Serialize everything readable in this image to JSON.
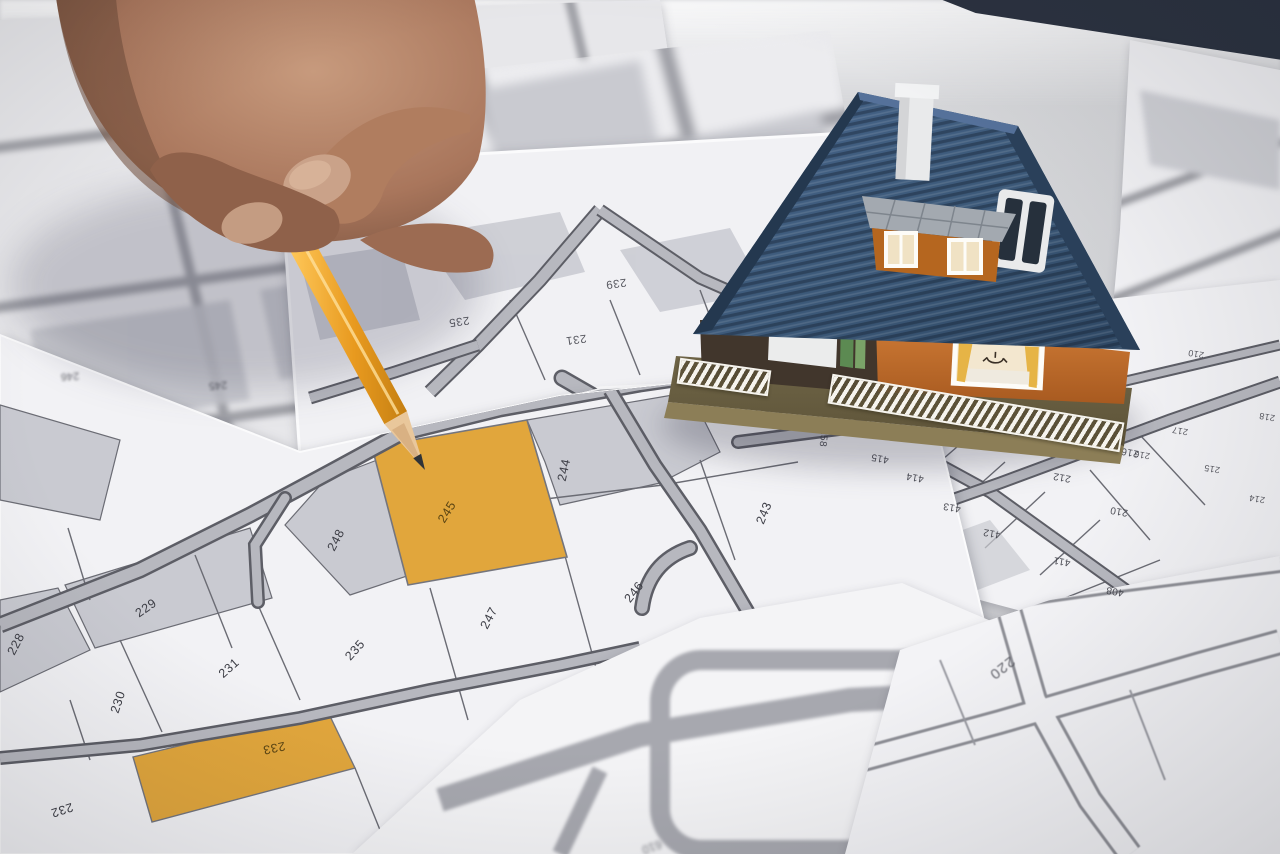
{
  "scene": {
    "subject": "hand with pencil pointing at highlighted cadastral parcel beside a model house",
    "highlighted_parcel": "245"
  },
  "colors": {
    "accent": "#e1a63c",
    "accent-deep": "#d2922a",
    "paper": "#f1f1f4",
    "parcel-gray": "#c9cad1",
    "road": "#b7b8bf",
    "road-edge": "#5d5e66",
    "line": "#6b6c74",
    "label": "#3c3d45",
    "desk": "#d3d4d7",
    "dark-corner": "#2b3240",
    "roof": "#3d5a7a",
    "roof-dark": "#2e4763",
    "wall": "#c4702e",
    "wall-dark": "#a85a20",
    "base": "#6f6547",
    "base-light": "#8c7e57",
    "fence": "#f6f4ee",
    "skin": "#a9765c",
    "skin-dark": "#7a5340",
    "skin-light": "#c79a7d",
    "pencil": "#f2a52e",
    "pencil-light": "#ffc95c",
    "pencil-dark": "#c57f12",
    "wood": "#e9c79b",
    "graphite": "#2f3338"
  },
  "maps": {
    "main_map": {
      "class": "lbl-main",
      "parcels": [
        {
          "label": "248",
          "x": 336,
          "y": 540,
          "rot": -62
        },
        {
          "label": "245",
          "x": 447,
          "y": 512,
          "rot": -58,
          "highlight": true
        },
        {
          "label": "244",
          "x": 564,
          "y": 470,
          "rot": -78
        },
        {
          "label": "243",
          "x": 764,
          "y": 513,
          "rot": -68
        },
        {
          "label": "246",
          "x": 634,
          "y": 592,
          "rot": -52
        },
        {
          "label": "247",
          "x": 489,
          "y": 618,
          "rot": -62
        },
        {
          "label": "235",
          "x": 355,
          "y": 650,
          "rot": -48
        },
        {
          "label": "229",
          "x": 146,
          "y": 608,
          "rot": -35
        },
        {
          "label": "228",
          "x": 16,
          "y": 644,
          "rot": -62
        },
        {
          "label": "231",
          "x": 229,
          "y": 668,
          "rot": -42
        },
        {
          "label": "230",
          "x": 118,
          "y": 702,
          "rot": -72
        },
        {
          "label": "233",
          "x": 274,
          "y": 748,
          "rot": 168,
          "highlight": true
        },
        {
          "label": "232",
          "x": 62,
          "y": 810,
          "rot": 162
        }
      ]
    },
    "upper_map": {
      "class": "lbl-upper",
      "parcels": [
        {
          "label": "239",
          "x": 616,
          "y": 283,
          "rot": 172
        },
        {
          "label": "231",
          "x": 576,
          "y": 339,
          "rot": 172
        },
        {
          "label": "235",
          "x": 459,
          "y": 321,
          "rot": 172
        }
      ]
    },
    "blur_map": {
      "class": "lbl-blur",
      "parcels": [
        {
          "label": "246",
          "x": 70,
          "y": 376,
          "rot": 176
        },
        {
          "label": "245",
          "x": 218,
          "y": 385,
          "rot": 176
        }
      ]
    },
    "house_map": {
      "class": "lbl-house",
      "parcels": [
        {
          "label": "258",
          "x": 823,
          "y": 438,
          "rot": 96
        },
        {
          "label": "416",
          "x": 1007,
          "y": 447,
          "rot": 190
        },
        {
          "label": "415",
          "x": 880,
          "y": 458,
          "rot": 190
        },
        {
          "label": "414",
          "x": 915,
          "y": 477,
          "rot": 190
        },
        {
          "label": "413",
          "x": 952,
          "y": 507,
          "rot": 190
        },
        {
          "label": "412",
          "x": 992,
          "y": 533,
          "rot": 190
        },
        {
          "label": "411",
          "x": 1062,
          "y": 561,
          "rot": 190
        },
        {
          "label": "212",
          "x": 1062,
          "y": 477,
          "rot": 190
        },
        {
          "label": "210",
          "x": 1119,
          "y": 511,
          "rot": 190
        },
        {
          "label": "216",
          "x": 1130,
          "y": 452,
          "rot": 190
        },
        {
          "label": "408",
          "x": 1115,
          "y": 591,
          "rot": 190
        }
      ]
    },
    "right_map": {
      "class": "lbl-right",
      "parcels": [
        {
          "label": "210",
          "x": 1196,
          "y": 354,
          "rot": 190
        },
        {
          "label": "218",
          "x": 1267,
          "y": 417,
          "rot": 190
        },
        {
          "label": "217",
          "x": 1180,
          "y": 431,
          "rot": 190
        },
        {
          "label": "216",
          "x": 1142,
          "y": 455,
          "rot": 190
        },
        {
          "label": "215",
          "x": 1212,
          "y": 469,
          "rot": 190
        },
        {
          "label": "214",
          "x": 1257,
          "y": 499,
          "rot": 190
        }
      ]
    },
    "bottom_right_map": {
      "class": "lbl-br",
      "parcels": [
        {
          "label": "220",
          "x": 1002,
          "y": 668,
          "rot": 142
        }
      ]
    }
  }
}
